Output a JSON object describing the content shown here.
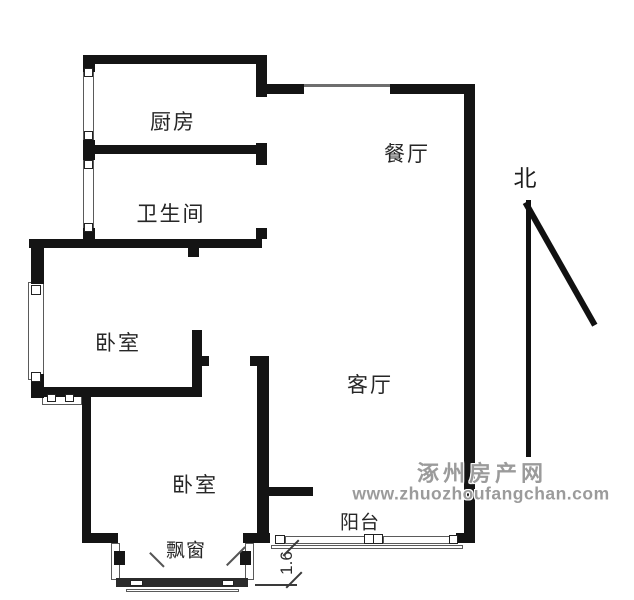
{
  "rooms": {
    "kitchen": "厨房",
    "bathroom": "卫生间",
    "dining": "餐厅",
    "bedroom1": "卧室",
    "bedroom2": "卧室",
    "living": "客厅",
    "balcony": "阳台",
    "bay_window": "飘窗"
  },
  "compass": {
    "north": "北"
  },
  "dimension": {
    "value": "1.6"
  },
  "watermark": {
    "site_name": "涿州房产网",
    "site_url": "www.zhuozhoufangchan.com",
    "color": "#9b9b9b"
  },
  "colors": {
    "wall": "#141414",
    "background": "#ffffff",
    "label": "#262626"
  }
}
